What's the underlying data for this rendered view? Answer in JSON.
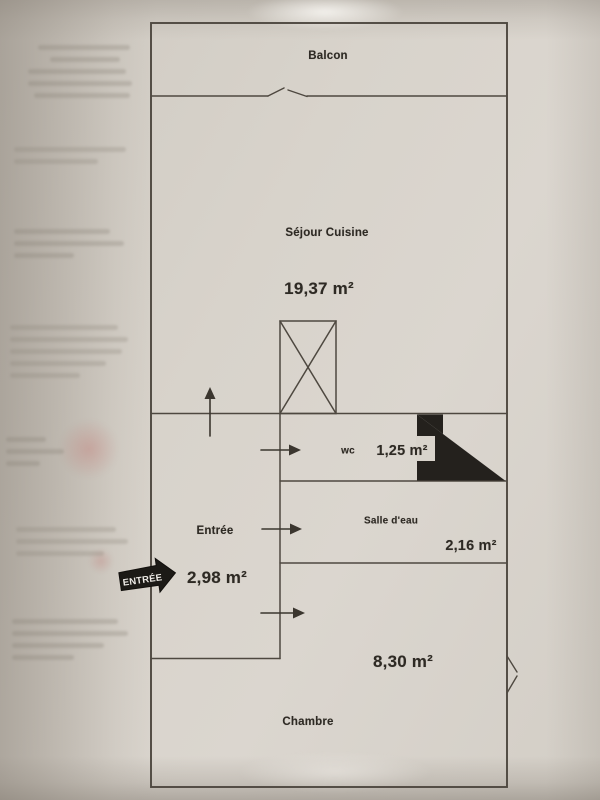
{
  "floorplan": {
    "rooms": {
      "balcon": {
        "label": "Balcon"
      },
      "sejour_cuisine": {
        "label": "Séjour Cuisine",
        "area": "19,37 m²"
      },
      "wc": {
        "label": "wc",
        "area": "1,25 m²"
      },
      "entree": {
        "label": "Entrée",
        "area": "2,98 m²"
      },
      "salle_eau": {
        "label": "Salle d'eau",
        "area": "2,16 m²"
      },
      "chambre": {
        "label": "Chambre",
        "area": "8,30 m²"
      }
    },
    "entrance_badge": {
      "label": "ENTRÉE"
    },
    "icons": {
      "shaft_symbol": "crossed-box-shaft-icon",
      "entry_direction": "up-arrow-icon",
      "door_direction": "right-arrow-icon",
      "door_fill": "black-triangle-icon",
      "wall_opening": "opening-notch-icon"
    },
    "colors": {
      "wall": "#4e4840",
      "ink": "#2e2a24",
      "paper": "#d8d3cb",
      "badge_bg": "#1c1a16",
      "badge_text": "#efece7"
    }
  }
}
